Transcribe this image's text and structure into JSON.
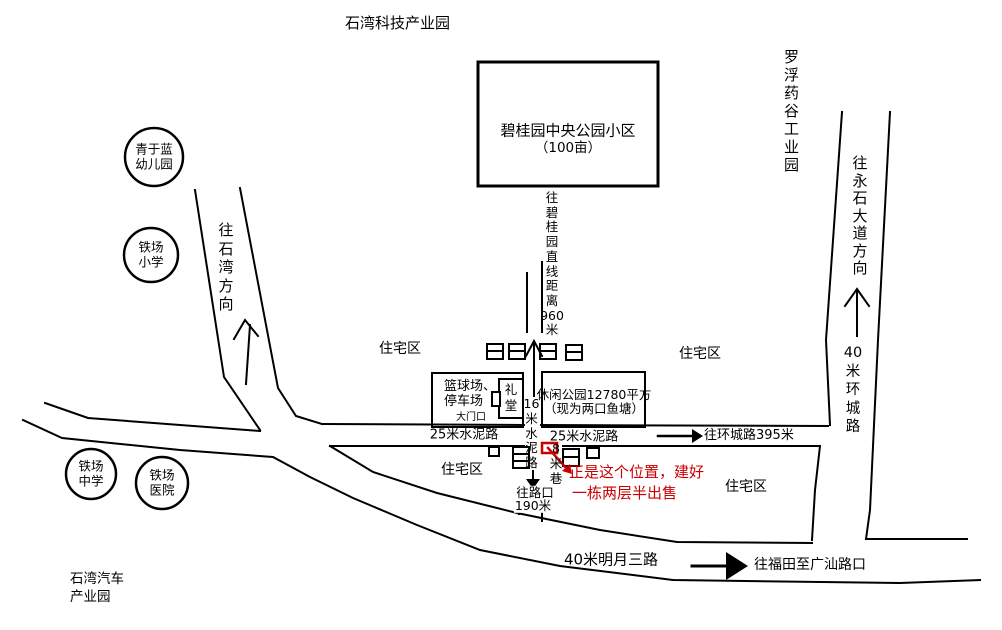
{
  "colors": {
    "ink": "#000000",
    "highlight": "#cc0000",
    "background": "#ffffff"
  },
  "districts": {
    "top_park": "石湾科技产业园",
    "luofu_park": "罗浮药谷工业园",
    "auto_park_line1": "石湾汽车",
    "auto_park_line2": "产业园",
    "residential_1": "住宅区",
    "residential_2": "住宅区",
    "residential_3": "住宅区",
    "residential_4": "住宅区"
  },
  "landmark_circles": [
    {
      "line1": "青于蓝",
      "line2": "幼儿园"
    },
    {
      "line1": "铁场",
      "line2": "小学"
    },
    {
      "line1": "铁场",
      "line2": "中学"
    },
    {
      "line1": "铁场",
      "line2": "医院"
    }
  ],
  "buildings": {
    "bgy_line1": "碧桂园中央公园小区",
    "bgy_line2": "（100亩）",
    "basketball_line1": "篮球场、",
    "basketball_line2": "停车场",
    "hall": "礼堂",
    "gate": "大门口",
    "park_line1": "休闲公园12780平方",
    "park_line2": "（现为两口鱼塘）"
  },
  "roads": {
    "to_bgy_distance": "往碧桂园直线距离960米",
    "cement16": "16米水泥路",
    "cement25_left": "25米水泥路",
    "cement25_right": "25米水泥路",
    "alley8": "8米巷",
    "ring_road": "40米环城路",
    "to_ring_road": "往环城路395米",
    "to_yongshi": "往永石大道方向",
    "to_shiwan": "往石湾方向",
    "mingyue_road": "40米明月三路",
    "to_futian": "往福田至广汕路口",
    "to_intersection_line1": "往路口",
    "to_intersection_line2": "190米"
  },
  "highlight_note": {
    "line1": "正是这个位置，建好",
    "line2": "一栋两层半出售"
  }
}
